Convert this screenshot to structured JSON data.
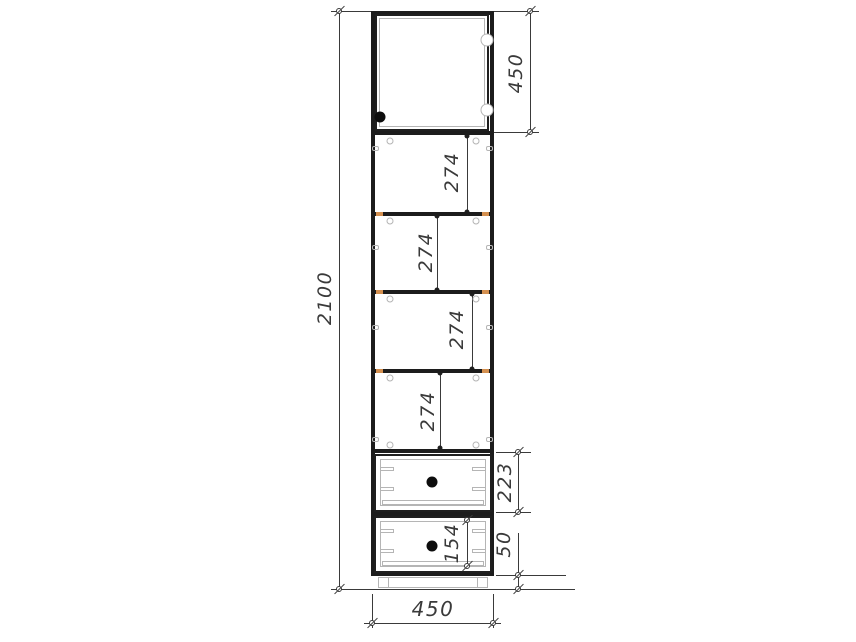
{
  "drawing": {
    "title": "tall-cabinet-front-elevation",
    "dims": {
      "overall_height": "2100",
      "door_height": "450",
      "section_1": "274",
      "section_2": "274",
      "section_3": "274",
      "section_4": "274",
      "drawer_section": "223",
      "drawer_inner": "154",
      "plinth_height": "50",
      "overall_width": "450"
    },
    "colors": {
      "line": "#1c1c1c",
      "dim": "#3a3a3a",
      "detail": "#b5b5b5",
      "wood": "#d49050",
      "knob": "#0d0d0d"
    }
  }
}
